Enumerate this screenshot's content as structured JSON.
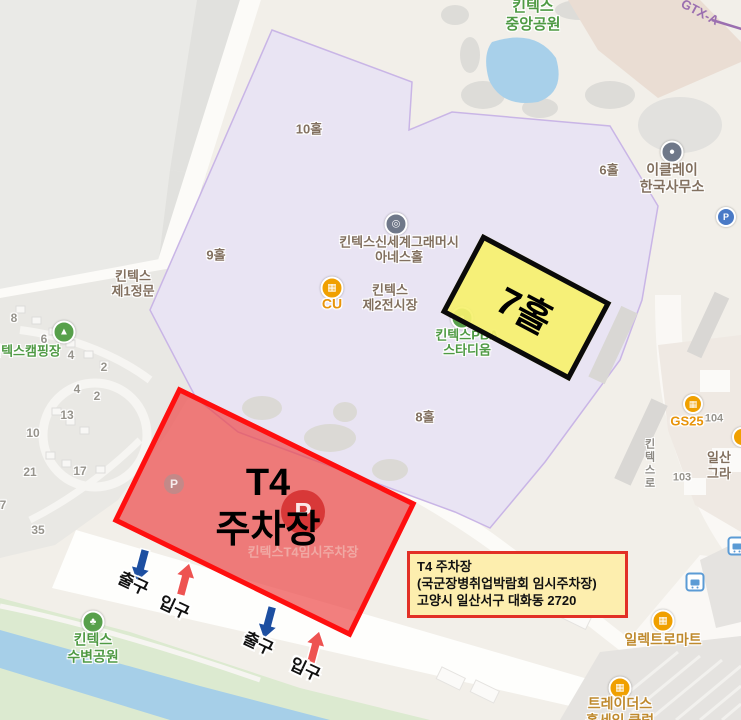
{
  "park": {
    "l1": "킨텍스",
    "l2": "중앙공원"
  },
  "transit": {
    "gtx": "GTX-A"
  },
  "halls": {
    "h10": "10홀",
    "h9": "9홀",
    "h6": "6홀",
    "h8": "8홀"
  },
  "pois": {
    "gate1_1": "킨텍스",
    "gate1_2": "제1정문",
    "shinsegae_1": "킨텍스신세계그래머시",
    "shinsegae_2": "아네스홀",
    "cu": "CU",
    "exh2_1": "킨텍스",
    "exh2_2": "제2전시장",
    "pba_1": "킨텍스PBA",
    "pba_2": "스타디움",
    "iclei_1": "이클레이",
    "iclei_2": "한국사무소",
    "camp": "킨텍스캠핑장",
    "riverside_1": "킨텍스",
    "riverside_2": "수변공원",
    "gs25": "GS25",
    "n104": "104",
    "n103": "103",
    "road_kintex": "킨텍스로",
    "frag_1": "일산",
    "frag_2": "그라",
    "electromart": "일렉트로마트",
    "traders_1": "트레이더스",
    "traders_2": "홀세일 클럽",
    "p": "P"
  },
  "campnums": [
    "8",
    "6",
    "4",
    "2",
    "4",
    "2",
    "13",
    "10",
    "21",
    "17",
    "7",
    "35"
  ],
  "overlay": {
    "t4_1": "T4",
    "t4_2": "주차장",
    "t4_sub": "킨텍스T4임시주차장",
    "hall7": "7홀",
    "info_1": "T4 주차장",
    "info_2": "(국군장병취업박람회 임시주차장)",
    "info_3": "고양시 일산서구 대화동 2720"
  },
  "gates": {
    "exit": "출구",
    "entrance": "입구"
  },
  "colors": {
    "overlay_red_border": "#ff0f0f",
    "overlay_red_fill": "rgba(236,73,73,0.70)",
    "overlay_yellow_fill": "rgba(246,241,110,0.92)",
    "overlay_black_border": "#0a0a0a",
    "infobox_bg": "#fdeeae",
    "infobox_border": "#e23026",
    "purple_area": "#e9e4f3",
    "river": "#a6cfe8",
    "arrow_blue": "#1d4fa1",
    "arrow_red": "#ee5351",
    "poi_green": "#57a04b",
    "poi_orange": "#f0a000",
    "gtx_purple": "#9b6fb0"
  }
}
